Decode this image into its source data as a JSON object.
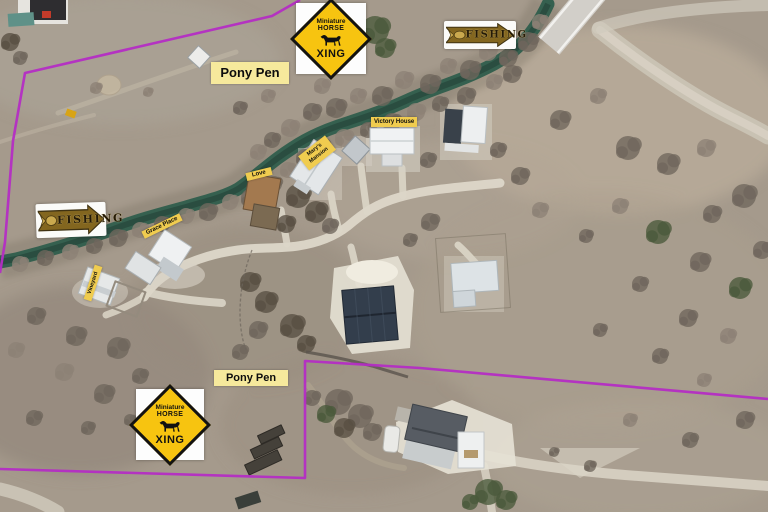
{
  "scene": {
    "kind": "annotated aerial property photo",
    "features": [
      "creek",
      "bridge",
      "gravel roads",
      "cabins",
      "barn",
      "pastures"
    ]
  },
  "labels": {
    "pony_pen_top": "Pony Pen",
    "pony_pen_bottom": "Pony Pen",
    "victory_house": "Victory House",
    "marys_mansion": {
      "line1": "Mary's",
      "line2": "Mansion"
    },
    "love": "Love",
    "grace_place": "Grace Place",
    "vineyard": "Vineyard"
  },
  "signs": {
    "horse_xing": {
      "line1": "Miniature",
      "line2": "HORSE",
      "line3": "XING"
    },
    "fishing": "FISHING"
  },
  "colors": {
    "boundary": "#b42dc4",
    "label_yellow": "#f0cc4f",
    "pony_pen_yellow": "#f6e99c",
    "xing_yellow": "#f7c410",
    "creek_green": "#35604f",
    "fishing_arrow_brown": "#83661f"
  }
}
